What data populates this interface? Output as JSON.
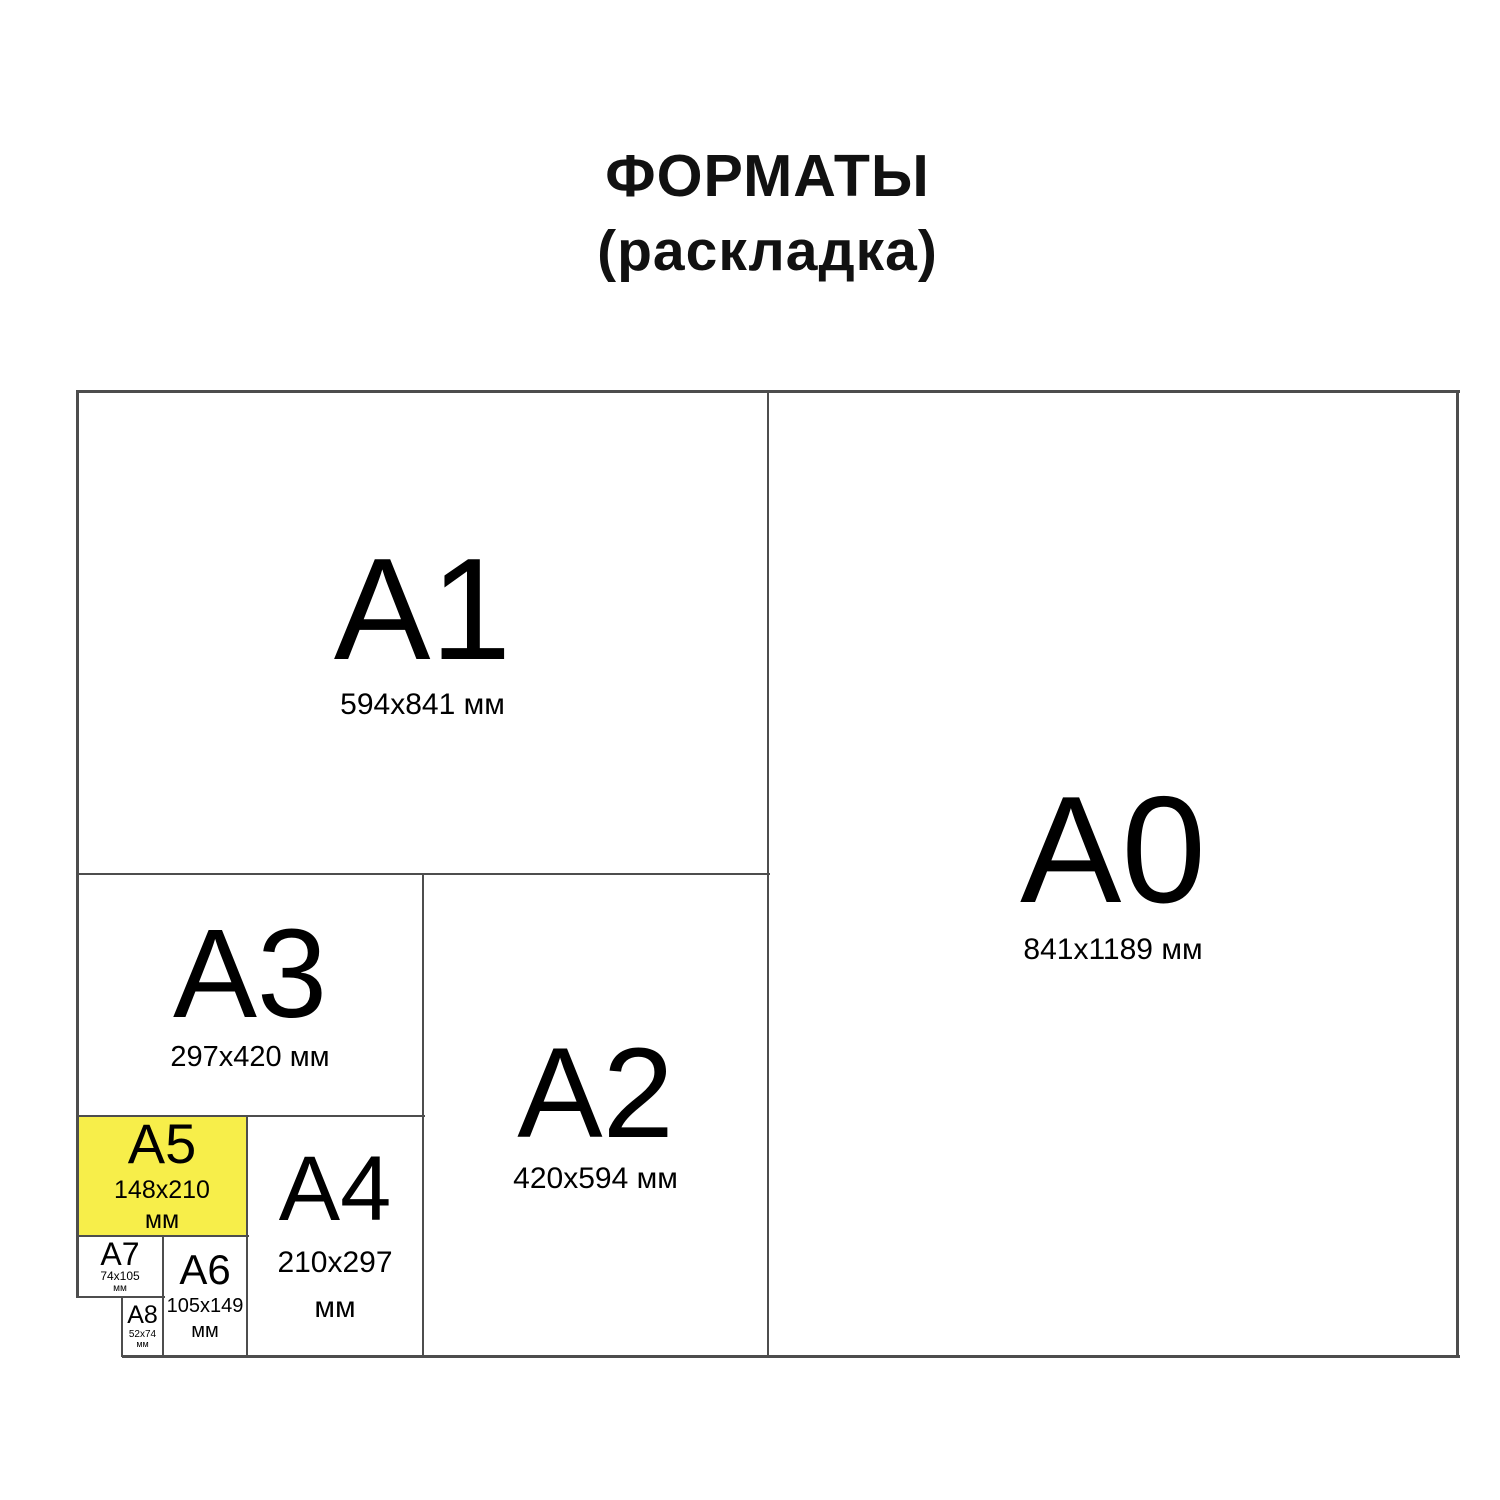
{
  "title": {
    "line1": "ФОРМАТЫ",
    "line2": "(раскладка)"
  },
  "colors": {
    "background": "#ffffff",
    "text": "#000000",
    "line": "#4d4d4d",
    "highlight_fill": "#f7ee4a"
  },
  "formats": {
    "a0": {
      "label": "A0",
      "dims": "841x1189 мм",
      "highlighted": false
    },
    "a1": {
      "label": "A1",
      "dims": "594x841 мм",
      "highlighted": false
    },
    "a2": {
      "label": "A2",
      "dims": "420x594 мм",
      "highlighted": false
    },
    "a3": {
      "label": "A3",
      "dims": "297x420 мм",
      "highlighted": false
    },
    "a4": {
      "label": "A4",
      "dims": "210x297",
      "unit": "мм",
      "highlighted": false
    },
    "a5": {
      "label": "A5",
      "dims": "148x210",
      "unit": "мм",
      "highlighted": true
    },
    "a6": {
      "label": "A6",
      "dims": "105x149",
      "unit": "мм",
      "highlighted": false
    },
    "a7": {
      "label": "A7",
      "dims": "74x105",
      "unit": "мм",
      "highlighted": false
    },
    "a8": {
      "label": "A8",
      "dims": "52x74",
      "unit": "мм",
      "highlighted": false
    }
  }
}
